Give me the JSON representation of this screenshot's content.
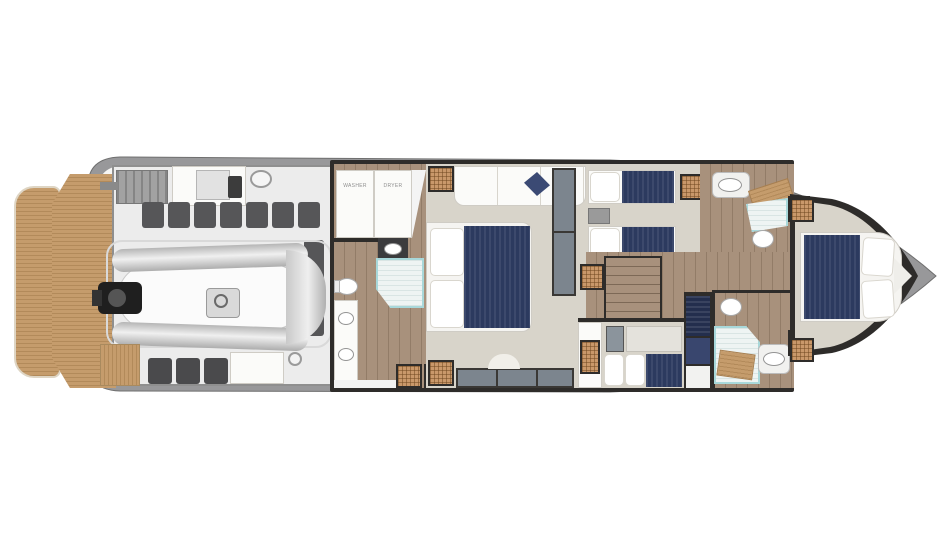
{
  "diagram": {
    "type": "yacht-lower-deck-floor-plan",
    "labels": {
      "washer": "WASHER",
      "dryer": "DRYER"
    },
    "colors": {
      "teak": "#c59c6c",
      "teakDark": "#b28a5a",
      "wood": "#a8917c",
      "woodDark": "#9d8671",
      "carpet": "#d8d4ca",
      "wall": "#2e2c2a",
      "navy": "#2c3a5f",
      "navyDark": "#232e4d",
      "hull": "#98989a",
      "deck": "#f6f6f4",
      "slate": "#7c858e",
      "wicker": "#c9986a",
      "glass": "#a8d8da",
      "glassFill": "#eef4f3",
      "equip": "#565658",
      "engineFloor": "#ececec",
      "background": "#ffffff",
      "labelColor": "#8f8f8f"
    }
  }
}
